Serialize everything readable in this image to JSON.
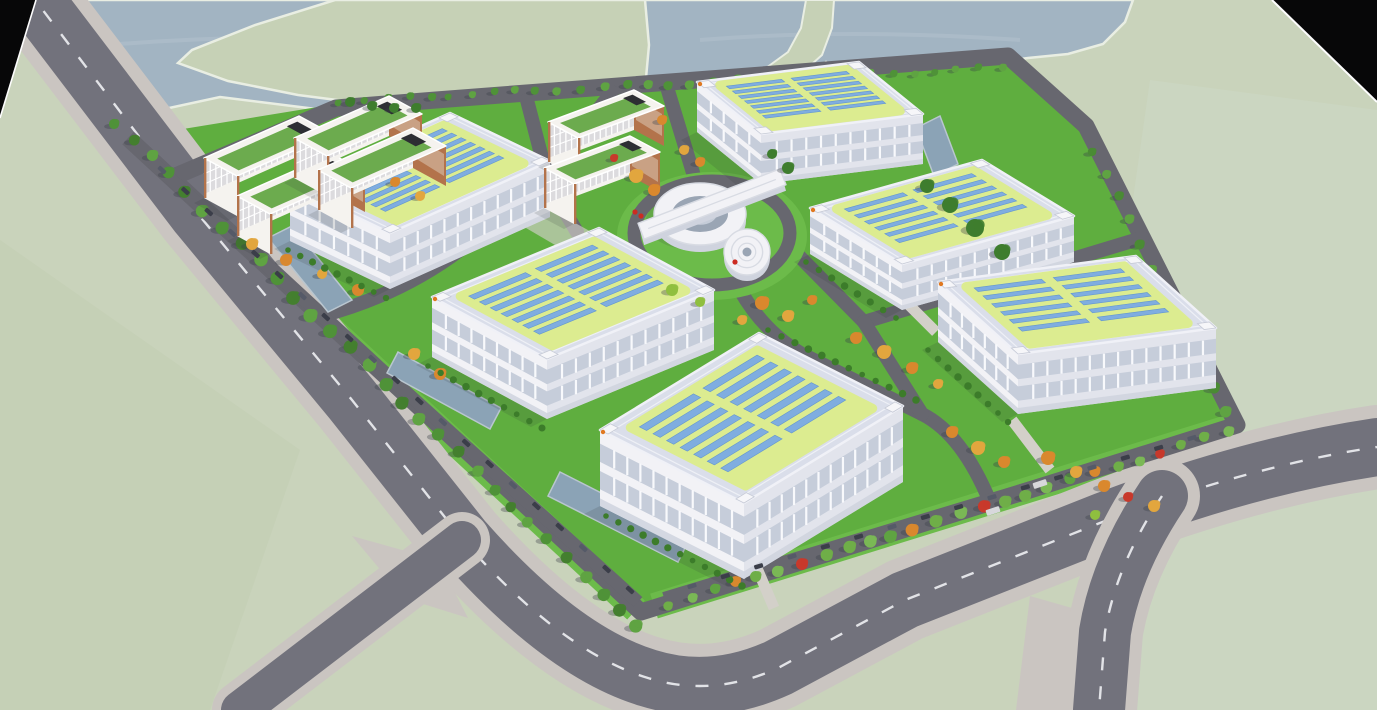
{
  "meta": {
    "kind": "3d-architectural-aerial-rendering",
    "subject": "industrial-park-campus-with-rooftop-solar",
    "view": "bird's-eye oblique"
  },
  "palette": {
    "bg": "#c9d3bb",
    "bgRight": "#cdd8c5",
    "bgBottomLeft": "#c2cdb2",
    "water": "#a2b4c2",
    "island": "#c6d1b6",
    "shore": "#e9eee3",
    "cornerBlack": "#070708",
    "cornerEdge": "#fdfdfd",
    "roadOuter": "#72727c",
    "roadInner": "#67676f",
    "sidewalk": "#cac5c1",
    "dash": "#eef0f3",
    "lawn": "#5fae3f",
    "lawnBright": "#6cbb4a",
    "hedge": "#3c7c2a",
    "treeGreen": "#4f9238",
    "treeDark": "#3e7d2e",
    "treeLight": "#7ab855",
    "treeOrange": "#d9882e",
    "treeAmber": "#e2a63e",
    "treeRed": "#c8392b",
    "treeYellowGreen": "#8fbf3f",
    "shadow": "#394049",
    "carDark": "#3b3e49",
    "carMid": "#555a68",
    "truck": "#d8d8dc",
    "wallWhite": "#f2f2f6",
    "wallShade": "#e2e4ec",
    "wallBase": "#cfd3de",
    "windowBand": "#c6cdda",
    "mullion": "#f8f9fc",
    "roof": "#dadeea",
    "roofEdge": "#f0f1f7",
    "parapet": "#f6f6f9",
    "solarPad": "#dcec90",
    "solarPanel": "#7fade0",
    "solarPanelEdge": "#6397cf",
    "officeWall": "#f5f3ef",
    "officeTrim": "#b3734b",
    "officeWindow": "#dcdbde",
    "officeEndBand": "#c9a184",
    "officeRoofGreen": "#6cab4e",
    "bulkhead": "#2d2e33",
    "poolWater": "#8ba3b6",
    "poolEdge": "#b9c6cf",
    "concrete": "#d3d0c9",
    "orangeDot": "#e07820",
    "ringInner": "#9aa5b4",
    "ringMid": "#c5ccd8",
    "circBand": "#d8dbe3"
  },
  "scene": {
    "background": {
      "rightTint": "M1150,80 L1377,110 L1377,710 L1060,710 Z",
      "bottomLeftTint": "M0,240 L300,450 L210,710 L0,710 Z"
    },
    "water": {
      "body": "M36,0 L1133,0 L1125,22 L1103,44 L1068,54 L1028,58 L983,64 L933,77 L888,88 L848,80 L826,62 L800,82 L760,94 L722,102 L684,117 L655,130 L640,142 L600,142 L540,137 L460,127 L380,117 L300,107 L220,97 L160,110 L118,107 L78,92 L44,52 Z",
      "island": "M335,0 L255,25 L192,50 L178,63 L228,81 L298,95 L368,104 L438,112 L498,120 L556,128 L598,126 L628,113 L640,100 L646,78 L649,45 L645,0 Z",
      "spit": "M806,0 L801,28 L788,52 L766,68 L778,78 L803,72 L822,55 L832,28 L834,0 Z",
      "ripples": [
        "M120,44 Q300,30 470,46",
        "M700,40 Q850,28 1020,40",
        "M200,70 Q330,60 430,72"
      ]
    },
    "corners": {
      "topLeft": "M0,0 L36,0 L0,118 Z",
      "topRight": "M1272,0 L1377,0 L1377,102 Z",
      "topLeftEdge": "M36,0 L0,118",
      "topRightEdge": "M1272,0 L1377,102"
    },
    "campus": {
      "ground": "M128,138 L336,104 L438,96 L1010,50 L1092,122 L1242,422 L642,616 Z",
      "westBand": "M140,152 L636,610",
      "seBand": "M654,606 L1234,426"
    },
    "outerRoads": {
      "main": "M26,-12 L198,214 L352,400 L463,540 Q562,652 648,678 Q712,698 778,668 L905,600 L1105,521 Q1250,466 1377,447",
      "branch": "M1162,496 Q1116,565 1105,632 L1099,710",
      "stub": "M462,540 L240,710",
      "wedges": [
        "M1030,596 L1086,612 L1082,710 L1016,710 Z",
        "M352,536 L438,560 L468,618 L404,598 Z"
      ]
    },
    "innerRoads": {
      "ring": "M128,138 L641,612 L1237,425 L1086,126 L1008,56 L436,100 L336,108 L171,178",
      "spurs": [
        "M666,84 L697,186",
        "M612,92 Q540,185 460,250 Q400,295 321,316",
        "M795,252 L864,322",
        "M864,322 L1142,238",
        "M740,290 Q764,332 802,354 L922,414 Q962,434 990,502",
        "M864,322 L922,414",
        "M527,100 L549,185 L577,232"
      ],
      "parkingWest": "M152,162 L638,602",
      "parkingSE": "M664,598 L1226,428",
      "loop": {
        "cx": 712,
        "cy": 233,
        "rx": 78,
        "ry": 52
      },
      "concretePaths": [
        "M1012,420 L1050,470",
        "M756,566 L774,608",
        "M906,302 L936,332"
      ],
      "plaza": "M548,208 L606,240 L584,262 L526,228 Z"
    },
    "pools": [
      [
        [
          916,
          128
        ],
        [
          940,
          116
        ],
        [
          958,
          164
        ],
        [
          934,
          176
        ]
      ],
      [
        [
          268,
          238
        ],
        [
          292,
          226
        ],
        [
          352,
          300
        ],
        [
          328,
          312
        ]
      ],
      [
        [
          398,
          352
        ],
        [
          501,
          408
        ],
        [
          490,
          429
        ],
        [
          387,
          373
        ]
      ],
      [
        [
          560,
          472
        ],
        [
          690,
          538
        ],
        [
          678,
          562
        ],
        [
          548,
          496
        ]
      ]
    ],
    "factories": [
      {
        "id": "factory-top",
        "A": [
          697,
          82
        ],
        "u": [
          162,
          -20
        ],
        "v": [
          64,
          52
        ],
        "h": 50,
        "rows": 7
      },
      {
        "id": "factory-right-upper",
        "A": [
          810,
          208
        ],
        "u": [
          172,
          -48
        ],
        "v": [
          92,
          56
        ],
        "h": 46,
        "rows": 6
      },
      {
        "id": "factory-left-upper",
        "A": [
          290,
          185
        ],
        "u": [
          160,
          -72
        ],
        "v": [
          100,
          48
        ],
        "h": 56,
        "rows": 7
      },
      {
        "id": "factory-far-right",
        "A": [
          938,
          282
        ],
        "u": [
          198,
          -26
        ],
        "v": [
          80,
          72
        ],
        "h": 60,
        "rows": 6
      },
      {
        "id": "factory-center",
        "A": [
          432,
          297
        ],
        "u": [
          167,
          -69
        ],
        "v": [
          115,
          62
        ],
        "h": 60,
        "rows": 7
      },
      {
        "id": "factory-front",
        "A": [
          600,
          430
        ],
        "u": [
          159,
          -97
        ],
        "v": [
          144,
          73
        ],
        "h": 76,
        "rows": 7
      }
    ],
    "offices": [
      {
        "id": "office-a1",
        "A": [
          204,
          158
        ],
        "u": [
          95,
          -42
        ],
        "v": [
          33,
          18
        ],
        "h": 40
      },
      {
        "id": "office-a2",
        "A": [
          237,
          196
        ],
        "u": [
          95,
          -42
        ],
        "v": [
          33,
          18
        ],
        "h": 40
      },
      {
        "id": "office-a3",
        "A": [
          294,
          138
        ],
        "u": [
          95,
          -42
        ],
        "v": [
          33,
          18
        ],
        "h": 40
      },
      {
        "id": "office-a4",
        "A": [
          318,
          170
        ],
        "u": [
          95,
          -42
        ],
        "v": [
          33,
          18
        ],
        "h": 40
      },
      {
        "id": "office-b1",
        "A": [
          548,
          122
        ],
        "u": [
          86,
          -32
        ],
        "v": [
          30,
          16
        ],
        "h": 40
      },
      {
        "id": "office-b2",
        "A": [
          544,
          168
        ],
        "u": [
          86,
          -32
        ],
        "v": [
          30,
          16
        ],
        "h": 40
      }
    ],
    "circularBuilding": {
      "lawn": {
        "cx": 712,
        "cy": 236,
        "rx": 95,
        "ry": 64
      },
      "innerLawn": {
        "cx": 712,
        "cy": 232,
        "rx": 60,
        "ry": 38
      },
      "ring": {
        "cx": 700,
        "cy": 214,
        "rx": 46,
        "ry": 31
      },
      "court": {
        "rx": 28,
        "ry": 18
      },
      "bar": {
        "cx": 712,
        "cy": 204,
        "len": 152,
        "w": 17,
        "angle": -21
      },
      "cylinder": {
        "cx": 747,
        "cy": 252,
        "r": 23
      },
      "flowers": [
        [
          635,
          212
        ],
        [
          641,
          216
        ],
        [
          735,
          262
        ]
      ]
    },
    "treeRows": [
      {
        "id": "row-west",
        "from": [
          114,
          122
        ],
        "to": [
          638,
          628
        ],
        "n": 30,
        "r": 6,
        "colors": [
          "#4f9238",
          "#447f2f",
          "#5fa342"
        ],
        "before": true
      },
      {
        "id": "row-top",
        "from": [
          448,
          95
        ],
        "to": [
          1002,
          68
        ],
        "n": 26,
        "r": 4,
        "colors": [
          "#4f9238",
          "#5fa342"
        ],
        "before": true
      },
      {
        "id": "row-shore",
        "from": [
          338,
          101
        ],
        "to": [
          434,
          97
        ],
        "n": 5,
        "r": 4,
        "colors": [
          "#4f9238"
        ],
        "before": true
      },
      {
        "id": "row-ne",
        "from": [
          1092,
          150
        ],
        "to": [
          1228,
          410
        ],
        "n": 12,
        "r": 5,
        "colors": [
          "#4a8b34",
          "#5fa342"
        ],
        "before": true
      },
      {
        "id": "row-se",
        "from": [
          668,
          604
        ],
        "to": [
          1228,
          432
        ],
        "n": 26,
        "r": 5.5,
        "colors": [
          "#6fae48",
          "#7ab855",
          "#5fa342",
          "#d9882e",
          "#6fae48",
          "#7ab855",
          "#c8392b",
          "#6fae48"
        ],
        "before": false
      }
    ],
    "bigTrees": [
      [
        950,
        205,
        8
      ],
      [
        975,
        228,
        9
      ],
      [
        1002,
        252,
        8
      ],
      [
        927,
        186,
        7
      ],
      [
        788,
        168,
        6
      ],
      [
        772,
        154,
        5
      ],
      [
        350,
        102,
        5
      ],
      [
        372,
        106,
        5
      ],
      [
        394,
        108,
        5
      ],
      [
        416,
        108,
        5
      ]
    ],
    "autumnTrees": [
      [
        636,
        176,
        7,
        "#e2a63e"
      ],
      [
        654,
        190,
        6,
        "#d9882e"
      ],
      [
        614,
        158,
        4,
        "#c8392b"
      ],
      [
        700,
        162,
        5,
        "#d9882e"
      ],
      [
        684,
        150,
        5,
        "#e2a63e"
      ],
      [
        662,
        120,
        5,
        "#d9882e"
      ],
      [
        762,
        303,
        7,
        "#d9882e"
      ],
      [
        788,
        316,
        6,
        "#e2a63e"
      ],
      [
        812,
        300,
        5,
        "#d9882e"
      ],
      [
        742,
        320,
        5,
        "#e2a63e"
      ],
      [
        856,
        338,
        6,
        "#d9882e"
      ],
      [
        884,
        352,
        7,
        "#e2a63e"
      ],
      [
        912,
        368,
        6,
        "#d9882e"
      ],
      [
        938,
        384,
        5,
        "#e2a63e"
      ],
      [
        952,
        432,
        6,
        "#d9882e"
      ],
      [
        978,
        448,
        7,
        "#e2a63e"
      ],
      [
        1004,
        462,
        6,
        "#d9882e"
      ],
      [
        1048,
        458,
        7,
        "#d9882e"
      ],
      [
        1076,
        472,
        6,
        "#e2a63e"
      ],
      [
        1104,
        486,
        6,
        "#d9882e"
      ],
      [
        1128,
        497,
        5,
        "#c8392b"
      ],
      [
        1154,
        506,
        6,
        "#e2a63e"
      ],
      [
        252,
        244,
        6,
        "#e2a63e"
      ],
      [
        286,
        260,
        6,
        "#d9882e"
      ],
      [
        322,
        274,
        5,
        "#e2a63e"
      ],
      [
        358,
        290,
        6,
        "#d9882e"
      ],
      [
        414,
        354,
        6,
        "#e2a63e"
      ],
      [
        440,
        374,
        6,
        "#d9882e"
      ],
      [
        395,
        182,
        5,
        "#d9882e"
      ],
      [
        420,
        196,
        5,
        "#e2a63e"
      ],
      [
        672,
        290,
        6,
        "#8fbf3f"
      ],
      [
        700,
        302,
        5,
        "#8fbf3f"
      ],
      [
        1095,
        515,
        5,
        "#8fbf3f"
      ]
    ],
    "bushRows": [
      {
        "from": [
          606,
          516
        ],
        "to": [
          742,
          586
        ],
        "n": 12
      },
      {
        "from": [
          428,
          366
        ],
        "to": [
          542,
          428
        ],
        "n": 10
      },
      {
        "from": [
          288,
          250
        ],
        "to": [
          386,
          298
        ],
        "n": 9
      },
      {
        "from": [
          928,
          350
        ],
        "to": [
          1008,
          422
        ],
        "n": 9
      },
      {
        "from": [
          806,
          262
        ],
        "to": [
          896,
          318
        ],
        "n": 8
      },
      {
        "from": [
          768,
          330
        ],
        "to": [
          916,
          400
        ],
        "n": 12
      }
    ],
    "carRows": [
      {
        "id": "cars-west",
        "from": [
          162,
          170
        ],
        "to": [
          630,
          590
        ],
        "n": 21
      },
      {
        "id": "cars-se",
        "from": [
          692,
          586
        ],
        "to": [
          1192,
          438
        ],
        "n": 16
      }
    ],
    "trucks": [
      [
        993,
        511
      ],
      [
        1040,
        484
      ]
    ]
  }
}
